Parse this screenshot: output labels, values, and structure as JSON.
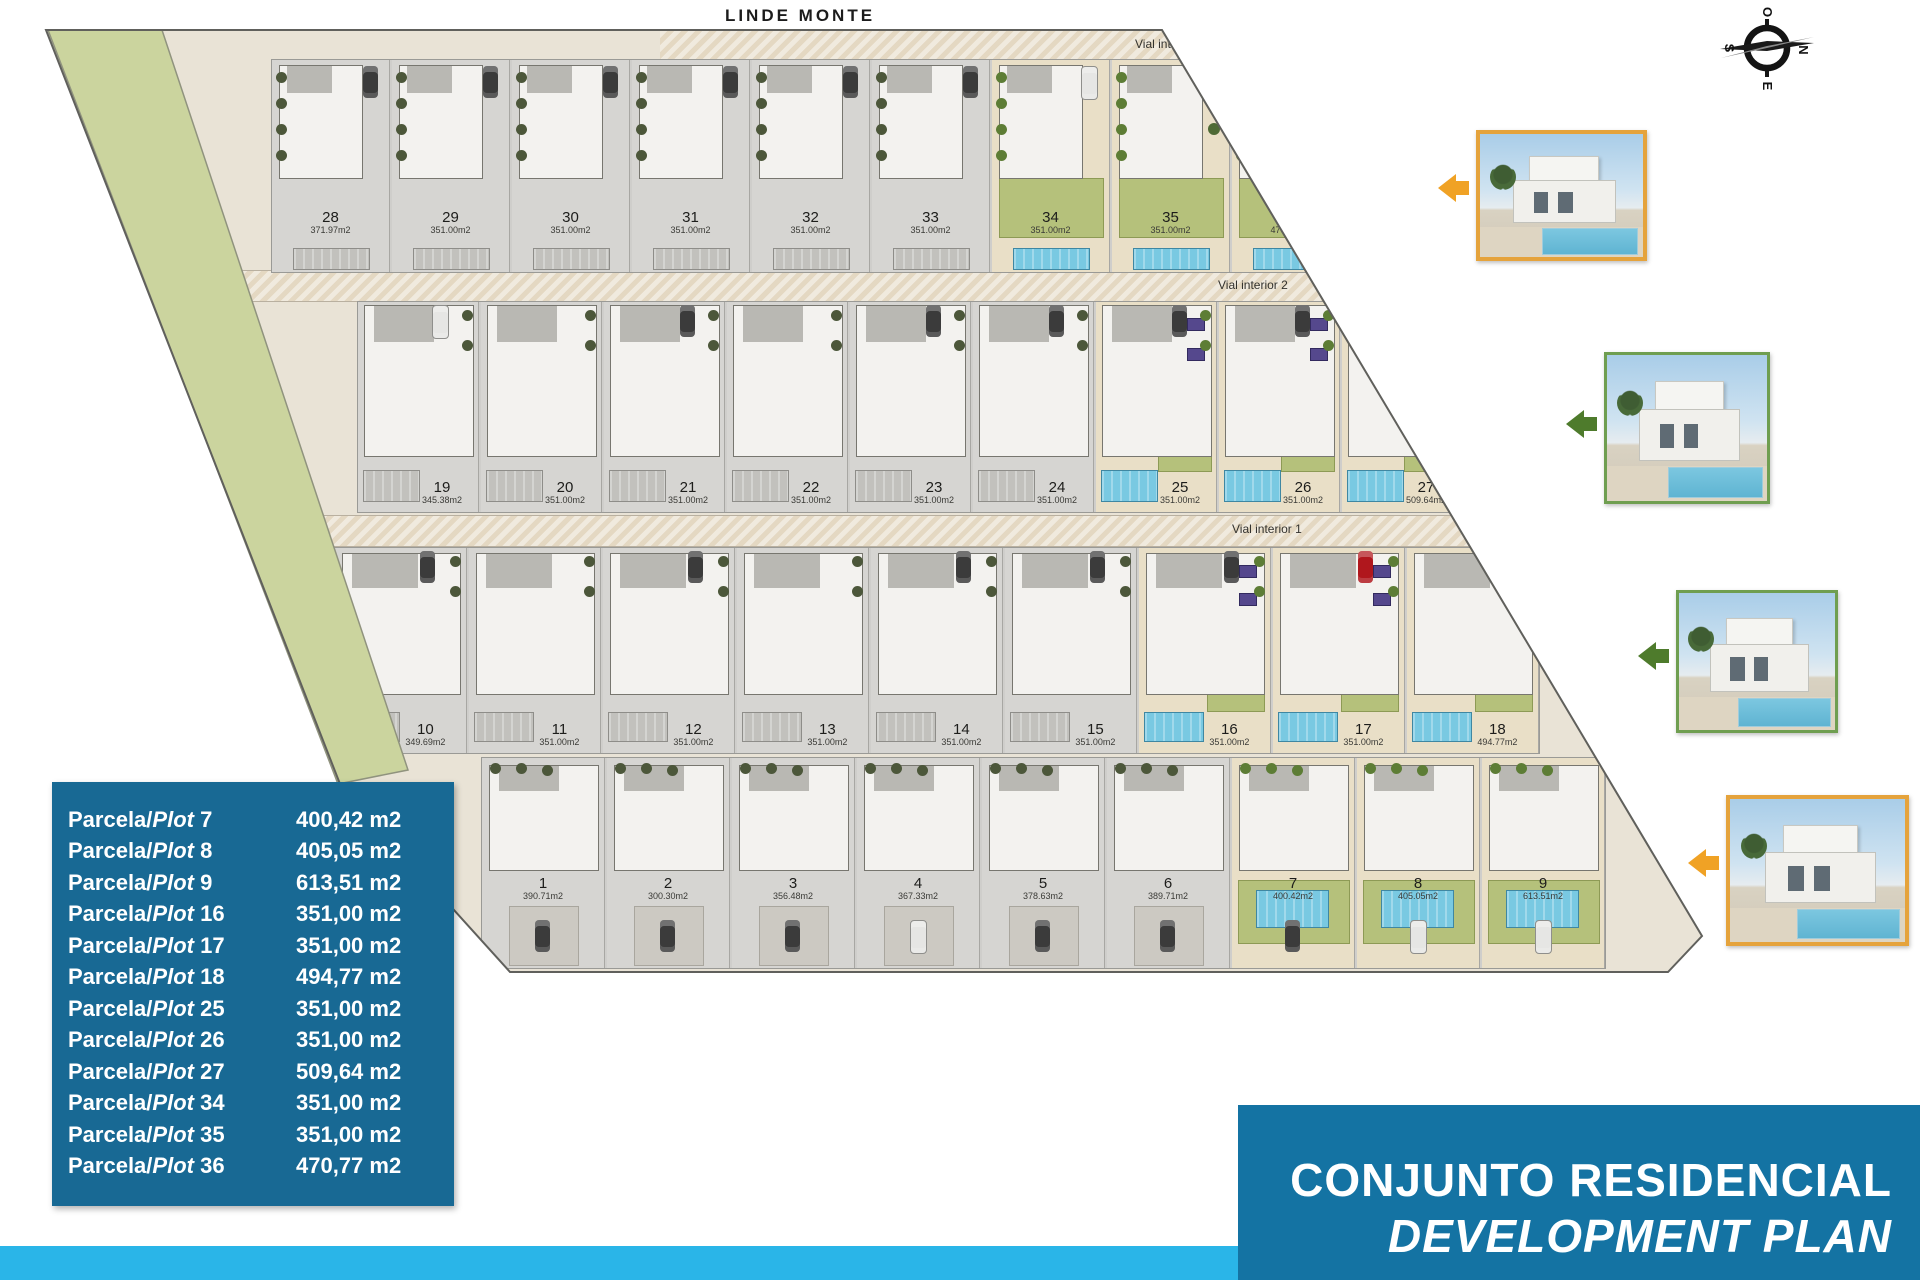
{
  "title": "LINDE MONTE",
  "compass": {
    "top": "O",
    "right": "N",
    "bottom": "E",
    "left": "S"
  },
  "plan": {
    "streets": [
      {
        "id": "vial-3",
        "label": "Vial interior 3"
      },
      {
        "id": "vial-2",
        "label": "Vial interior 2"
      },
      {
        "id": "vial-1",
        "label": "Vial interior 1"
      }
    ],
    "rows": [
      {
        "id": "row-28-36",
        "plots": [
          {
            "num": "28",
            "area": "371.97m2",
            "active": false,
            "car": "dark"
          },
          {
            "num": "29",
            "area": "351.00m2",
            "active": false,
            "car": "dark"
          },
          {
            "num": "30",
            "area": "351.00m2",
            "active": false,
            "car": "dark"
          },
          {
            "num": "31",
            "area": "351.00m2",
            "active": false,
            "car": "dark"
          },
          {
            "num": "32",
            "area": "351.00m2",
            "active": false,
            "car": "dark"
          },
          {
            "num": "33",
            "area": "351.00m2",
            "active": false,
            "car": "dark"
          },
          {
            "num": "34",
            "area": "351.00m2",
            "active": true,
            "car": "white"
          },
          {
            "num": "35",
            "area": "351.00m2",
            "active": true,
            "car": "white"
          },
          {
            "num": "36",
            "area": "470.77m2",
            "active": true,
            "car": "red"
          }
        ]
      },
      {
        "id": "row-19-27",
        "plots": [
          {
            "num": "19",
            "area": "345.38m2",
            "active": false,
            "car": "white"
          },
          {
            "num": "20",
            "area": "351.00m2",
            "active": false,
            "car": null
          },
          {
            "num": "21",
            "area": "351.00m2",
            "active": false,
            "car": "dark"
          },
          {
            "num": "22",
            "area": "351.00m2",
            "active": false,
            "car": null
          },
          {
            "num": "23",
            "area": "351.00m2",
            "active": false,
            "car": "dark"
          },
          {
            "num": "24",
            "area": "351.00m2",
            "active": false,
            "car": "dark"
          },
          {
            "num": "25",
            "area": "351.00m2",
            "active": true,
            "car": "dark"
          },
          {
            "num": "26",
            "area": "351.00m2",
            "active": true,
            "car": "dark"
          },
          {
            "num": "27",
            "area": "509.64m2",
            "active": true,
            "car": null
          }
        ]
      },
      {
        "id": "row-10-18",
        "plots": [
          {
            "num": "10",
            "area": "349.69m2",
            "active": false,
            "car": "dark"
          },
          {
            "num": "11",
            "area": "351.00m2",
            "active": false,
            "car": null
          },
          {
            "num": "12",
            "area": "351.00m2",
            "active": false,
            "car": "dark"
          },
          {
            "num": "13",
            "area": "351.00m2",
            "active": false,
            "car": null
          },
          {
            "num": "14",
            "area": "351.00m2",
            "active": false,
            "car": "dark"
          },
          {
            "num": "15",
            "area": "351.00m2",
            "active": false,
            "car": "dark"
          },
          {
            "num": "16",
            "area": "351.00m2",
            "active": true,
            "car": "dark"
          },
          {
            "num": "17",
            "area": "351.00m2",
            "active": true,
            "car": "red"
          },
          {
            "num": "18",
            "area": "494.77m2",
            "active": true,
            "car": "white"
          }
        ]
      },
      {
        "id": "row-1-9",
        "plots": [
          {
            "num": "1",
            "area": "390.71m2",
            "active": false,
            "car": "dark"
          },
          {
            "num": "2",
            "area": "300.30m2",
            "active": false,
            "car": "dark"
          },
          {
            "num": "3",
            "area": "356.48m2",
            "active": false,
            "car": "dark"
          },
          {
            "num": "4",
            "area": "367.33m2",
            "active": false,
            "car": "white"
          },
          {
            "num": "5",
            "area": "378.63m2",
            "active": false,
            "car": "dark"
          },
          {
            "num": "6",
            "area": "389.71m2",
            "active": false,
            "car": "dark"
          },
          {
            "num": "7",
            "area": "400.42m2",
            "active": true,
            "car": "dark"
          },
          {
            "num": "8",
            "area": "405.05m2",
            "active": true,
            "car": "white"
          },
          {
            "num": "9",
            "area": "613.51m2",
            "active": true,
            "car": "white"
          }
        ]
      }
    ]
  },
  "legend": {
    "rows": [
      {
        "es": "Parcela/",
        "en": "Plot",
        "num": "7",
        "area": "400,42 m2"
      },
      {
        "es": "Parcela/",
        "en": "Plot",
        "num": "8",
        "area": "405,05 m2"
      },
      {
        "es": "Parcela/",
        "en": "Plot",
        "num": "9",
        "area": "613,51 m2"
      },
      {
        "es": "Parcela/",
        "en": "Plot",
        "num": "16",
        "area": "351,00 m2"
      },
      {
        "es": "Parcela/",
        "en": "Plot",
        "num": "17",
        "area": "351,00 m2"
      },
      {
        "es": "Parcela/",
        "en": "Plot",
        "num": "18",
        "area": "494,77 m2"
      },
      {
        "es": "Parcela/",
        "en": "Plot",
        "num": "25",
        "area": "351,00 m2"
      },
      {
        "es": "Parcela/",
        "en": "Plot",
        "num": "26",
        "area": "351,00 m2"
      },
      {
        "es": "Parcela/",
        "en": "Plot",
        "num": "27",
        "area": "509,64 m2"
      },
      {
        "es": "Parcela/",
        "en": "Plot",
        "num": "34",
        "area": "351,00 m2"
      },
      {
        "es": "Parcela/",
        "en": "Plot",
        "num": "35",
        "area": "351,00 m2"
      },
      {
        "es": "Parcela/",
        "en": "Plot",
        "num": "36",
        "area": "470,77 m2"
      }
    ]
  },
  "photos": [
    {
      "id": "villa-photo-1",
      "border": "gold",
      "arrow": "orange"
    },
    {
      "id": "villa-photo-2",
      "border": "green_border",
      "arrow": "green"
    },
    {
      "id": "villa-photo-3",
      "border": "green_border",
      "arrow": "green"
    },
    {
      "id": "villa-photo-4",
      "border": "gold",
      "arrow": "orange"
    }
  ],
  "banner": {
    "line1": "CONJUNTO RESIDENCIAL",
    "line2": "DEVELOPMENT PLAN"
  },
  "colors": {
    "legend_bg": "#186994",
    "banner_bg": "#1473a3",
    "strip": "#2ab5e8",
    "gold": "#e5a33c",
    "green_border": "#6f9e50",
    "orange": "#f0a225",
    "green": "#4e7b2c",
    "pool": "#79c9e2",
    "lawn": "#b5c17b",
    "green_band": "#cbd49e"
  }
}
